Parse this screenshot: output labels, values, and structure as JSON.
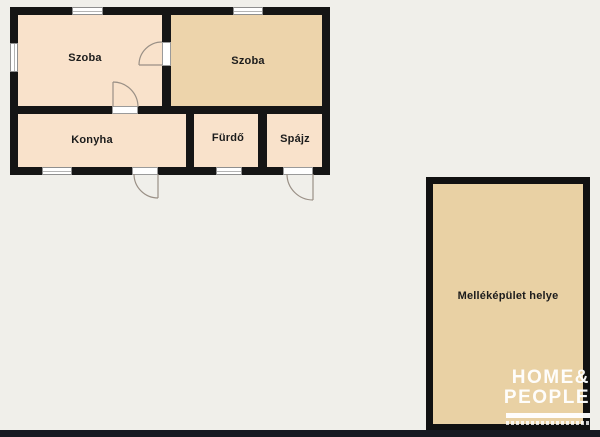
{
  "background_color": "#f0efea",
  "floor_plan": {
    "wall_color": "#151515",
    "room_fill_light": "#f9e2cb",
    "room_fill_dark": "#edd4ab",
    "outbuilding_fill": "#e9d1a4",
    "rooms": [
      {
        "id": "szoba1",
        "label": "Szoba"
      },
      {
        "id": "szoba2",
        "label": "Szoba"
      },
      {
        "id": "konyha",
        "label": "Konyha"
      },
      {
        "id": "furdo",
        "label": "Fürdő"
      },
      {
        "id": "spajz",
        "label": "Spájz"
      },
      {
        "id": "outbuilding",
        "label": "Melléképület helye"
      }
    ]
  },
  "watermark": {
    "line1": "HOME&",
    "line2": "PEOPLE",
    "color": "#ffffff"
  },
  "footer_bar_color": "#161921"
}
